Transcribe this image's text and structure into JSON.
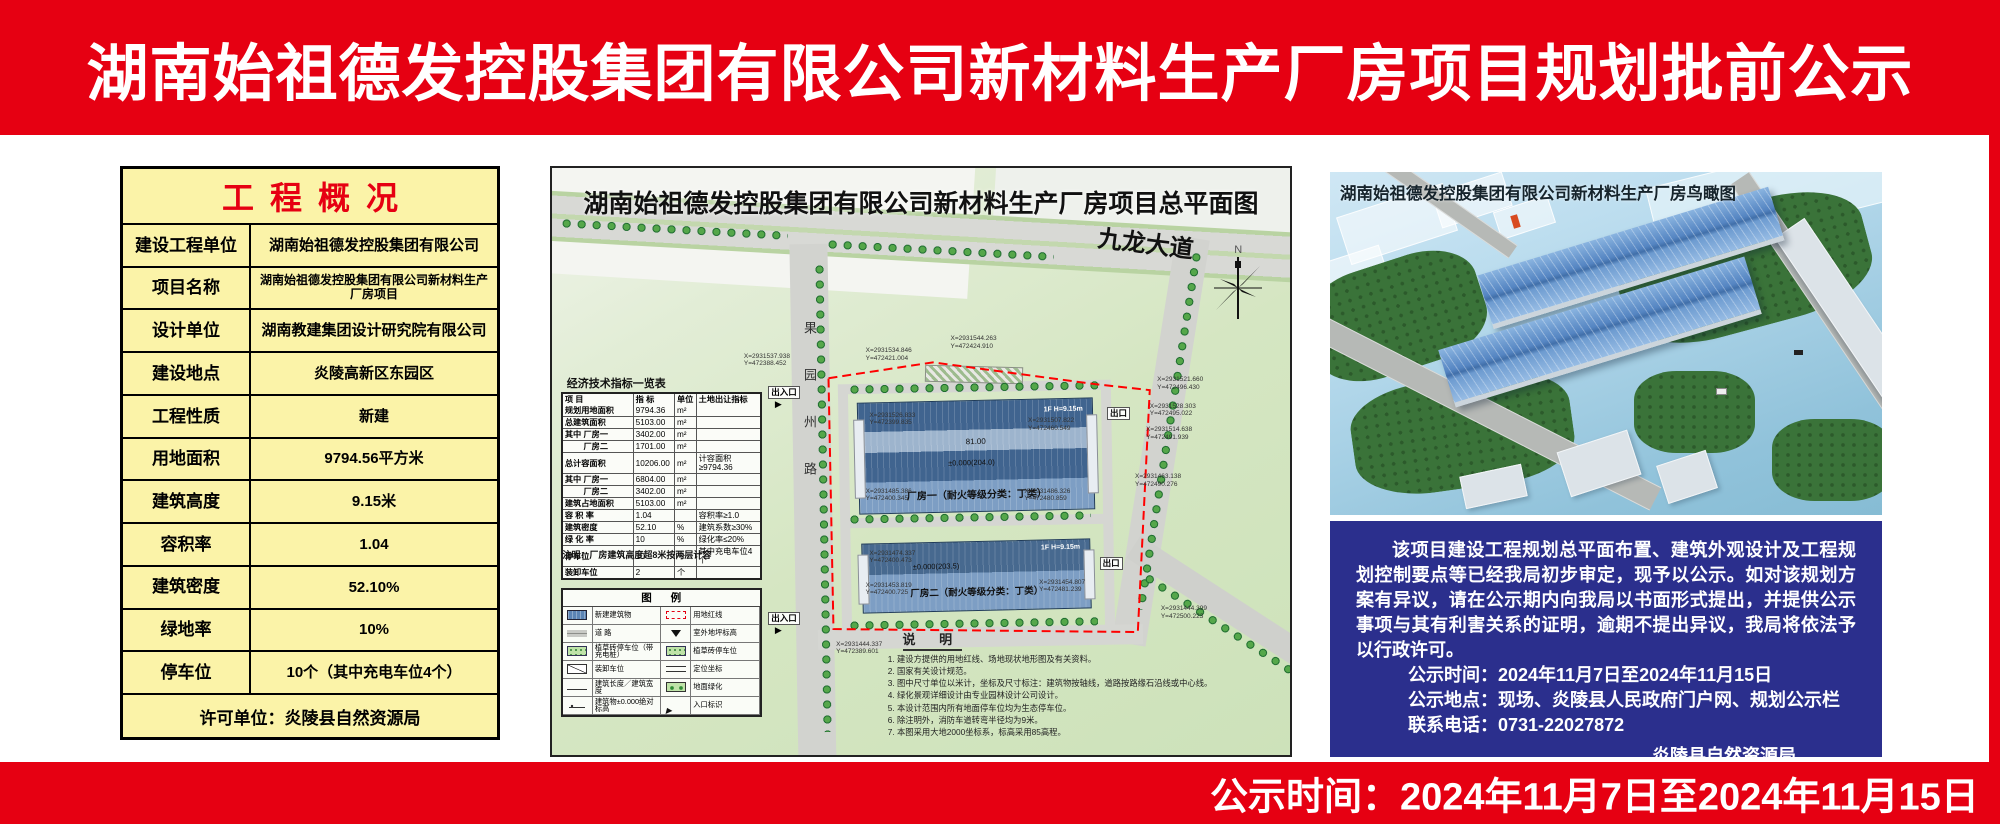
{
  "header": {
    "title": "湖南始祖德发控股集团有限公司新材料生产厂房项目规划批前公示"
  },
  "footer": {
    "text": "公示时间：2024年11月7日至2024年11月15日"
  },
  "colors": {
    "banner_red": "#e60012",
    "table_yellow": "#fbf3a8",
    "notice_blue": "#2b2f8d",
    "building_blue": "#4f81bd",
    "boundary_red": "#ff0000"
  },
  "overview": {
    "title": "工程概况",
    "rows": [
      [
        "建设工程单位",
        "湖南始祖德发控股集团有限公司"
      ],
      [
        "项目名称",
        "湖南始祖德发控股集团有限公司新材料生产厂房项目"
      ],
      [
        "设计单位",
        "湖南教建集团设计研究院有限公司"
      ],
      [
        "建设地点",
        "炎陵高新区东园区"
      ],
      [
        "工程性质",
        "新建"
      ],
      [
        "用地面积",
        "9794.56平方米"
      ],
      [
        "建筑高度",
        "9.15米"
      ],
      [
        "容积率",
        "1.04"
      ],
      [
        "建筑密度",
        "52.10%"
      ],
      [
        "绿地率",
        "10%"
      ],
      [
        "停车位",
        "10个（其中充电车位4个）"
      ]
    ],
    "footer": "许可单位：炎陵县自然资源局"
  },
  "site_plan": {
    "title": "湖南始祖德发控股集团有限公司新材料生产厂房项目总平面图",
    "road_main": "九龙大道",
    "road_left": "果园州路",
    "north_label": "N",
    "labels": {
      "entrance": "出入口",
      "exit": "出口",
      "floor": "1F H=9.15m",
      "dim": "81.00",
      "elev1": "±0.000(204.0)",
      "elev2": "±0.000(203.5)",
      "building1": "厂房一（耐火等级分类：丁类）",
      "building2": "厂房二（耐火等级分类：丁类）"
    },
    "indicator_table": {
      "title": "经济技术指标一览表",
      "headers": [
        "项  目",
        "指  标",
        "单位",
        "土地出让指标"
      ],
      "rows": [
        [
          "规划用地面积",
          "9794.36",
          "m²",
          ""
        ],
        [
          "总建筑面积",
          "5103.00",
          "m²",
          ""
        ],
        [
          "其中 厂房一",
          "3402.00",
          "m²",
          ""
        ],
        [
          "　　 厂房二",
          "1701.00",
          "m²",
          ""
        ],
        [
          "总计容面积",
          "10206.00",
          "m²",
          "计容面积≥9794.36"
        ],
        [
          "其中 厂房一",
          "6804.00",
          "m²",
          ""
        ],
        [
          "　　 厂房二",
          "3402.00",
          "m²",
          ""
        ],
        [
          "建筑占地面积",
          "5103.00",
          "m²",
          ""
        ],
        [
          "容 积 率",
          "1.04",
          "",
          "容积率≥1.0"
        ],
        [
          "建筑密度",
          "52.10",
          "%",
          "建筑系数≥30%"
        ],
        [
          "绿 化 率",
          "10",
          "%",
          "绿化率≤20%"
        ],
        [
          "停车位",
          "10",
          "个",
          "其中充电车位4个"
        ],
        [
          "装卸车位",
          "2",
          "个",
          ""
        ]
      ],
      "note": "注明：厂房建筑高度超8米按两层计容"
    },
    "legend": {
      "title": "图 例",
      "items": [
        {
          "symbol": "new-building",
          "label": "新建建筑物"
        },
        {
          "symbol": "red-line",
          "label": "用地红线"
        },
        {
          "symbol": "road",
          "label": "道 路"
        },
        {
          "symbol": "ground-elev",
          "label": "室外地坪标高"
        },
        {
          "symbol": "grass-parking-charge",
          "label": "植草砖停车位（带充电桩）"
        },
        {
          "symbol": "grass-parking",
          "label": "植草砖停车位"
        },
        {
          "symbol": "loading-space",
          "label": "装卸车位"
        },
        {
          "symbol": "coordinate",
          "label": "定位坐标"
        },
        {
          "symbol": "dimension",
          "label": "建筑长度／建筑宽度"
        },
        {
          "symbol": "greenery",
          "label": "地面绿化"
        },
        {
          "symbol": "abs-elev",
          "label": "建筑物±0.000绝对标高"
        },
        {
          "symbol": "entrance",
          "label": "入口标识"
        }
      ]
    },
    "notes": {
      "title": "说 明",
      "items": [
        "1. 建设方提供的用地红线、场地现状地形图及有关资料。",
        "2. 国家有关设计规范。",
        "3. 图中尺寸单位以米计，坐标及尺寸标注：建筑物按轴线，道路按路缘石沿线或中心线。",
        "4. 绿化景观详细设计由专业园林设计公司设计。",
        "5. 本设计范围内所有地面停车位均为生态停车位。",
        "6. 除注明外，消防车道转弯半径均为9米。",
        "7. 本图采用大地2000坐标系，标高采用85高程。"
      ]
    },
    "coords": [
      {
        "x": "26%",
        "y": "31.5%",
        "text": "X=2931537.938\nY=472388.452"
      },
      {
        "x": "42.5%",
        "y": "30.5%",
        "text": "X=2931534.846\nY=472421.004"
      },
      {
        "x": "54%",
        "y": "28.5%",
        "text": "X=2931544.263\nY=472424.910"
      },
      {
        "x": "82%",
        "y": "35.5%",
        "text": "X=2931521.660\nY=472496.430"
      },
      {
        "x": "81%",
        "y": "40%",
        "text": "X=2931528.303\nY=472495.022"
      },
      {
        "x": "80.5%",
        "y": "44%",
        "text": "X=2931514.638\nY=472491.939"
      },
      {
        "x": "43%",
        "y": "41.5%",
        "text": "X=2931526.833\nY=472399.835"
      },
      {
        "x": "64.5%",
        "y": "42.5%",
        "text": "X=2931507.822\nY=472460.549"
      },
      {
        "x": "42.5%",
        "y": "54.5%",
        "text": "X=2931485.386\nY=472400.345"
      },
      {
        "x": "64%",
        "y": "54.5%",
        "text": "X=2931486.326\nY=472480.859"
      },
      {
        "x": "79%",
        "y": "52%",
        "text": "X=2931463.138\nY=472490.276"
      },
      {
        "x": "43%",
        "y": "65%",
        "text": "X=2931474.337\nY=472400.473"
      },
      {
        "x": "42.5%",
        "y": "70.5%",
        "text": "X=2931453.819\nY=472400.725"
      },
      {
        "x": "66%",
        "y": "70%",
        "text": "X=2931454.807\nY=472481.239"
      },
      {
        "x": "82.5%",
        "y": "74.5%",
        "text": "X=2931444.399\nY=472500.223"
      },
      {
        "x": "38.5%",
        "y": "80.5%",
        "text": "X=2931444.337\nY=472389.601"
      }
    ]
  },
  "rendering": {
    "title": "湖南始祖德发控股集团有限公司新材料生产厂房鸟瞰图"
  },
  "notice": {
    "paragraph": "该项目建设工程规划总平面布置、建筑外观设计及工程规划控制要点等已经我局初步审定，现予以公示。如对该规划方案有异议，请在公示期内向我局以书面形式提出，并提供公示事项与其有利害关系的证明，逾期不提出异议，我局将依法予以行政许可。",
    "time": "公示时间：2024年11月7日至2024年11月15日",
    "place": "公示地点：现场、炎陵县人民政府门户网、规划公示栏",
    "phone": "联系电话：0731-22027872",
    "signature": "炎陵县自然资源局"
  }
}
